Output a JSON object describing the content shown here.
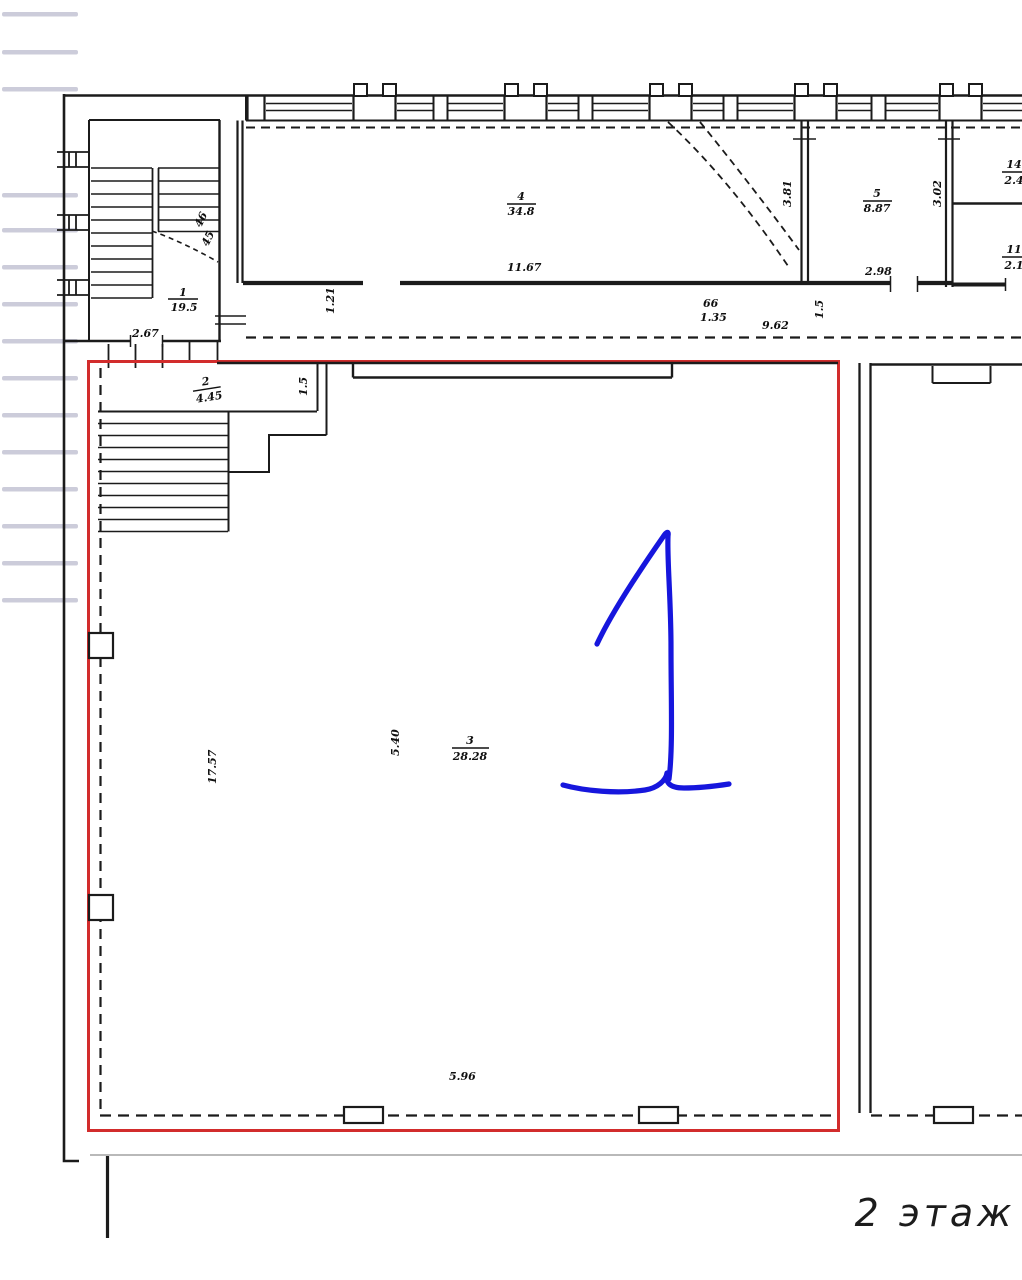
{
  "drawing": {
    "caption": "2 этаж",
    "colors": {
      "highlight": "#d22c2c",
      "annotation": "#1616dd",
      "ink": "#1b1b1b",
      "paper": "#ffffff"
    },
    "rooms": {
      "r1": {
        "number": "1",
        "area": "19.5"
      },
      "r2": {
        "number": "2",
        "area": "4.45"
      },
      "r3": {
        "number": "3",
        "area": "28.28"
      },
      "r4": {
        "number": "4",
        "area": "34.8"
      },
      "r5": {
        "number": "5",
        "area": "8.87"
      },
      "right_top": {
        "number": "14",
        "area": "2.4"
      },
      "right_bottom": {
        "number": "11",
        "area": "2.1"
      }
    },
    "dims": {
      "stair_door": "2.67",
      "corridor_w": "1.21",
      "room4_len": "11.67",
      "door_sup": "66",
      "door_w": "1.35",
      "corridor_len": "9.62",
      "corridor_w2": "1.5",
      "room5_door": "2.98",
      "room5_wall": "3.02",
      "room5_left": "3.81",
      "passage_w": "1.5",
      "room3_depth": "17.57",
      "room3_inner": "5.40",
      "room3_len": "5.96",
      "stair_note_a": "46",
      "stair_note_b": "45"
    }
  }
}
